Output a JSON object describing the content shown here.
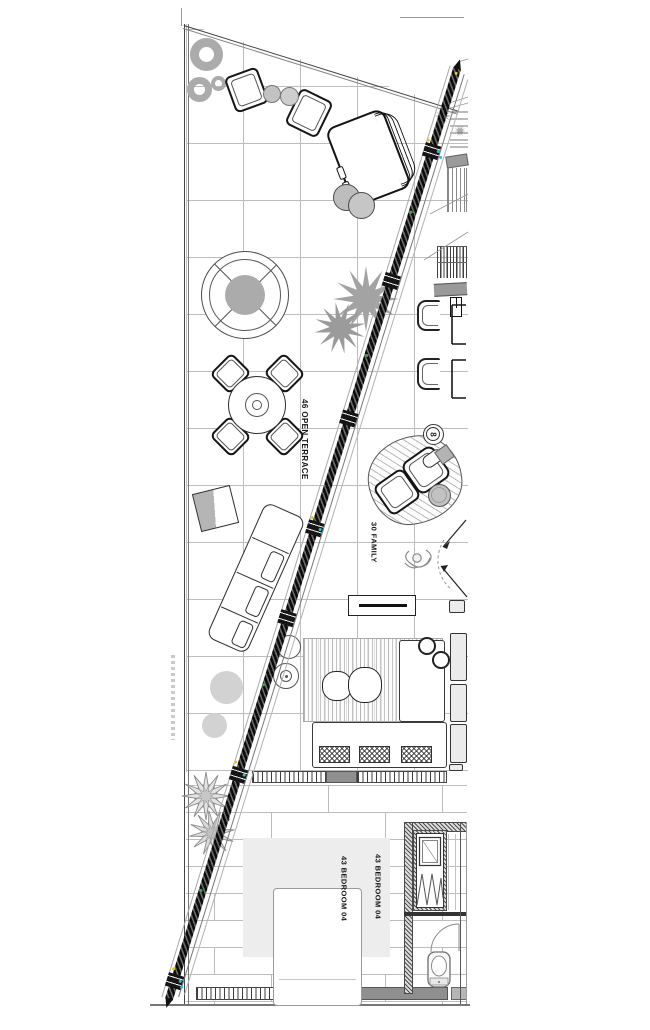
{
  "labels": {
    "open_terrace": "46 OPEN TERRACE",
    "family": "30 FAMILY",
    "bedroom_1": "43 BEDROOM 04",
    "bedroom_2": "43 BEDROOM 04",
    "lamp_number": "8"
  },
  "colors": {
    "wall_dark": "#1a1a1a",
    "line_dark": "#2e2e2e",
    "grid_line": "#b8b8b8",
    "fill_gray": "#c9c9c9",
    "fill_light": "#ececec",
    "accent_yellow": "#e2c51c",
    "accent_cyan": "#25c2d2",
    "accent_green": "#43a24a"
  },
  "icons": {
    "palm_plant": "radial-star",
    "star_plant": "star-burst",
    "glazed_wall": "hatched-diagonal-band",
    "toilet": "wc-plan-symbol",
    "door_swing": "quarter-arc",
    "hanger_rail": "zigzag",
    "floor_lamp": "circled-number"
  }
}
